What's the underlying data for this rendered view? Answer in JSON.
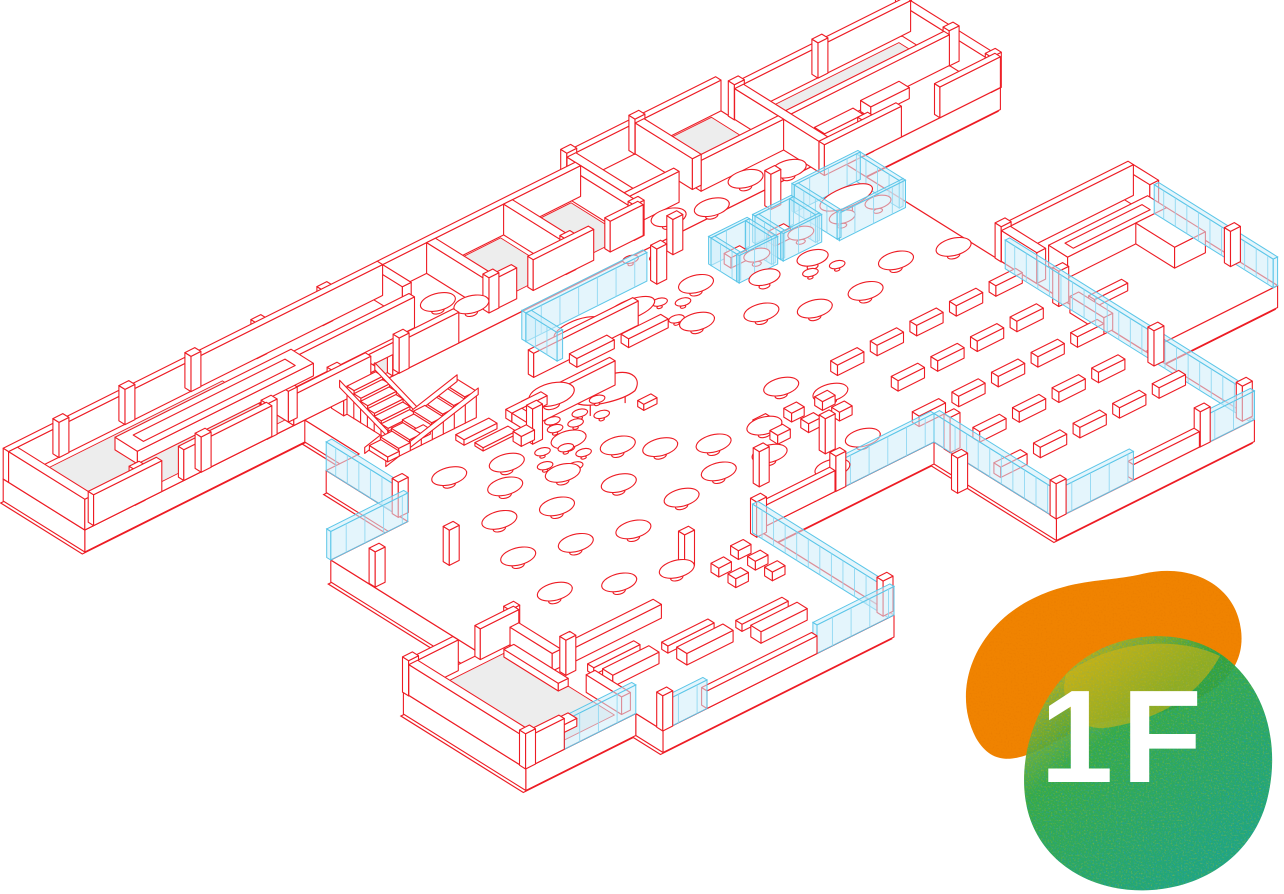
{
  "title": "Isometric floor plan illustration",
  "badge": {
    "floor_label": "1F",
    "orange": "#F08300",
    "green_main": "#25A53F",
    "green_teal": "#12A283",
    "speckle_blue": "#1E9BD2",
    "speckle_yellow": "#D5C522",
    "overlap_yellow": "#D9B511",
    "text_color": "#FFFFFF"
  },
  "palette": {
    "line_red": "#ED1C24",
    "floor_gray": "#EDEDED",
    "wall_white": "#FFFFFF",
    "glass_fill": "rgba(205,237,250,0.55)",
    "glass_stroke": "#5BC6E8",
    "glass_mullion": "#90D8F2",
    "background": "#FFFFFF"
  },
  "areas": [
    "gallery-wing",
    "gallery-display-table",
    "stair-hall",
    "scissor-stairs",
    "south-room",
    "cafe-zone",
    "central-hall",
    "glass-lounge",
    "piano-corner",
    "meeting-booths",
    "oval-meeting-room",
    "north-rooms",
    "top-right-wing",
    "east-room",
    "reading-room",
    "reading-desks",
    "glass-curtain-walls",
    "columns"
  ]
}
